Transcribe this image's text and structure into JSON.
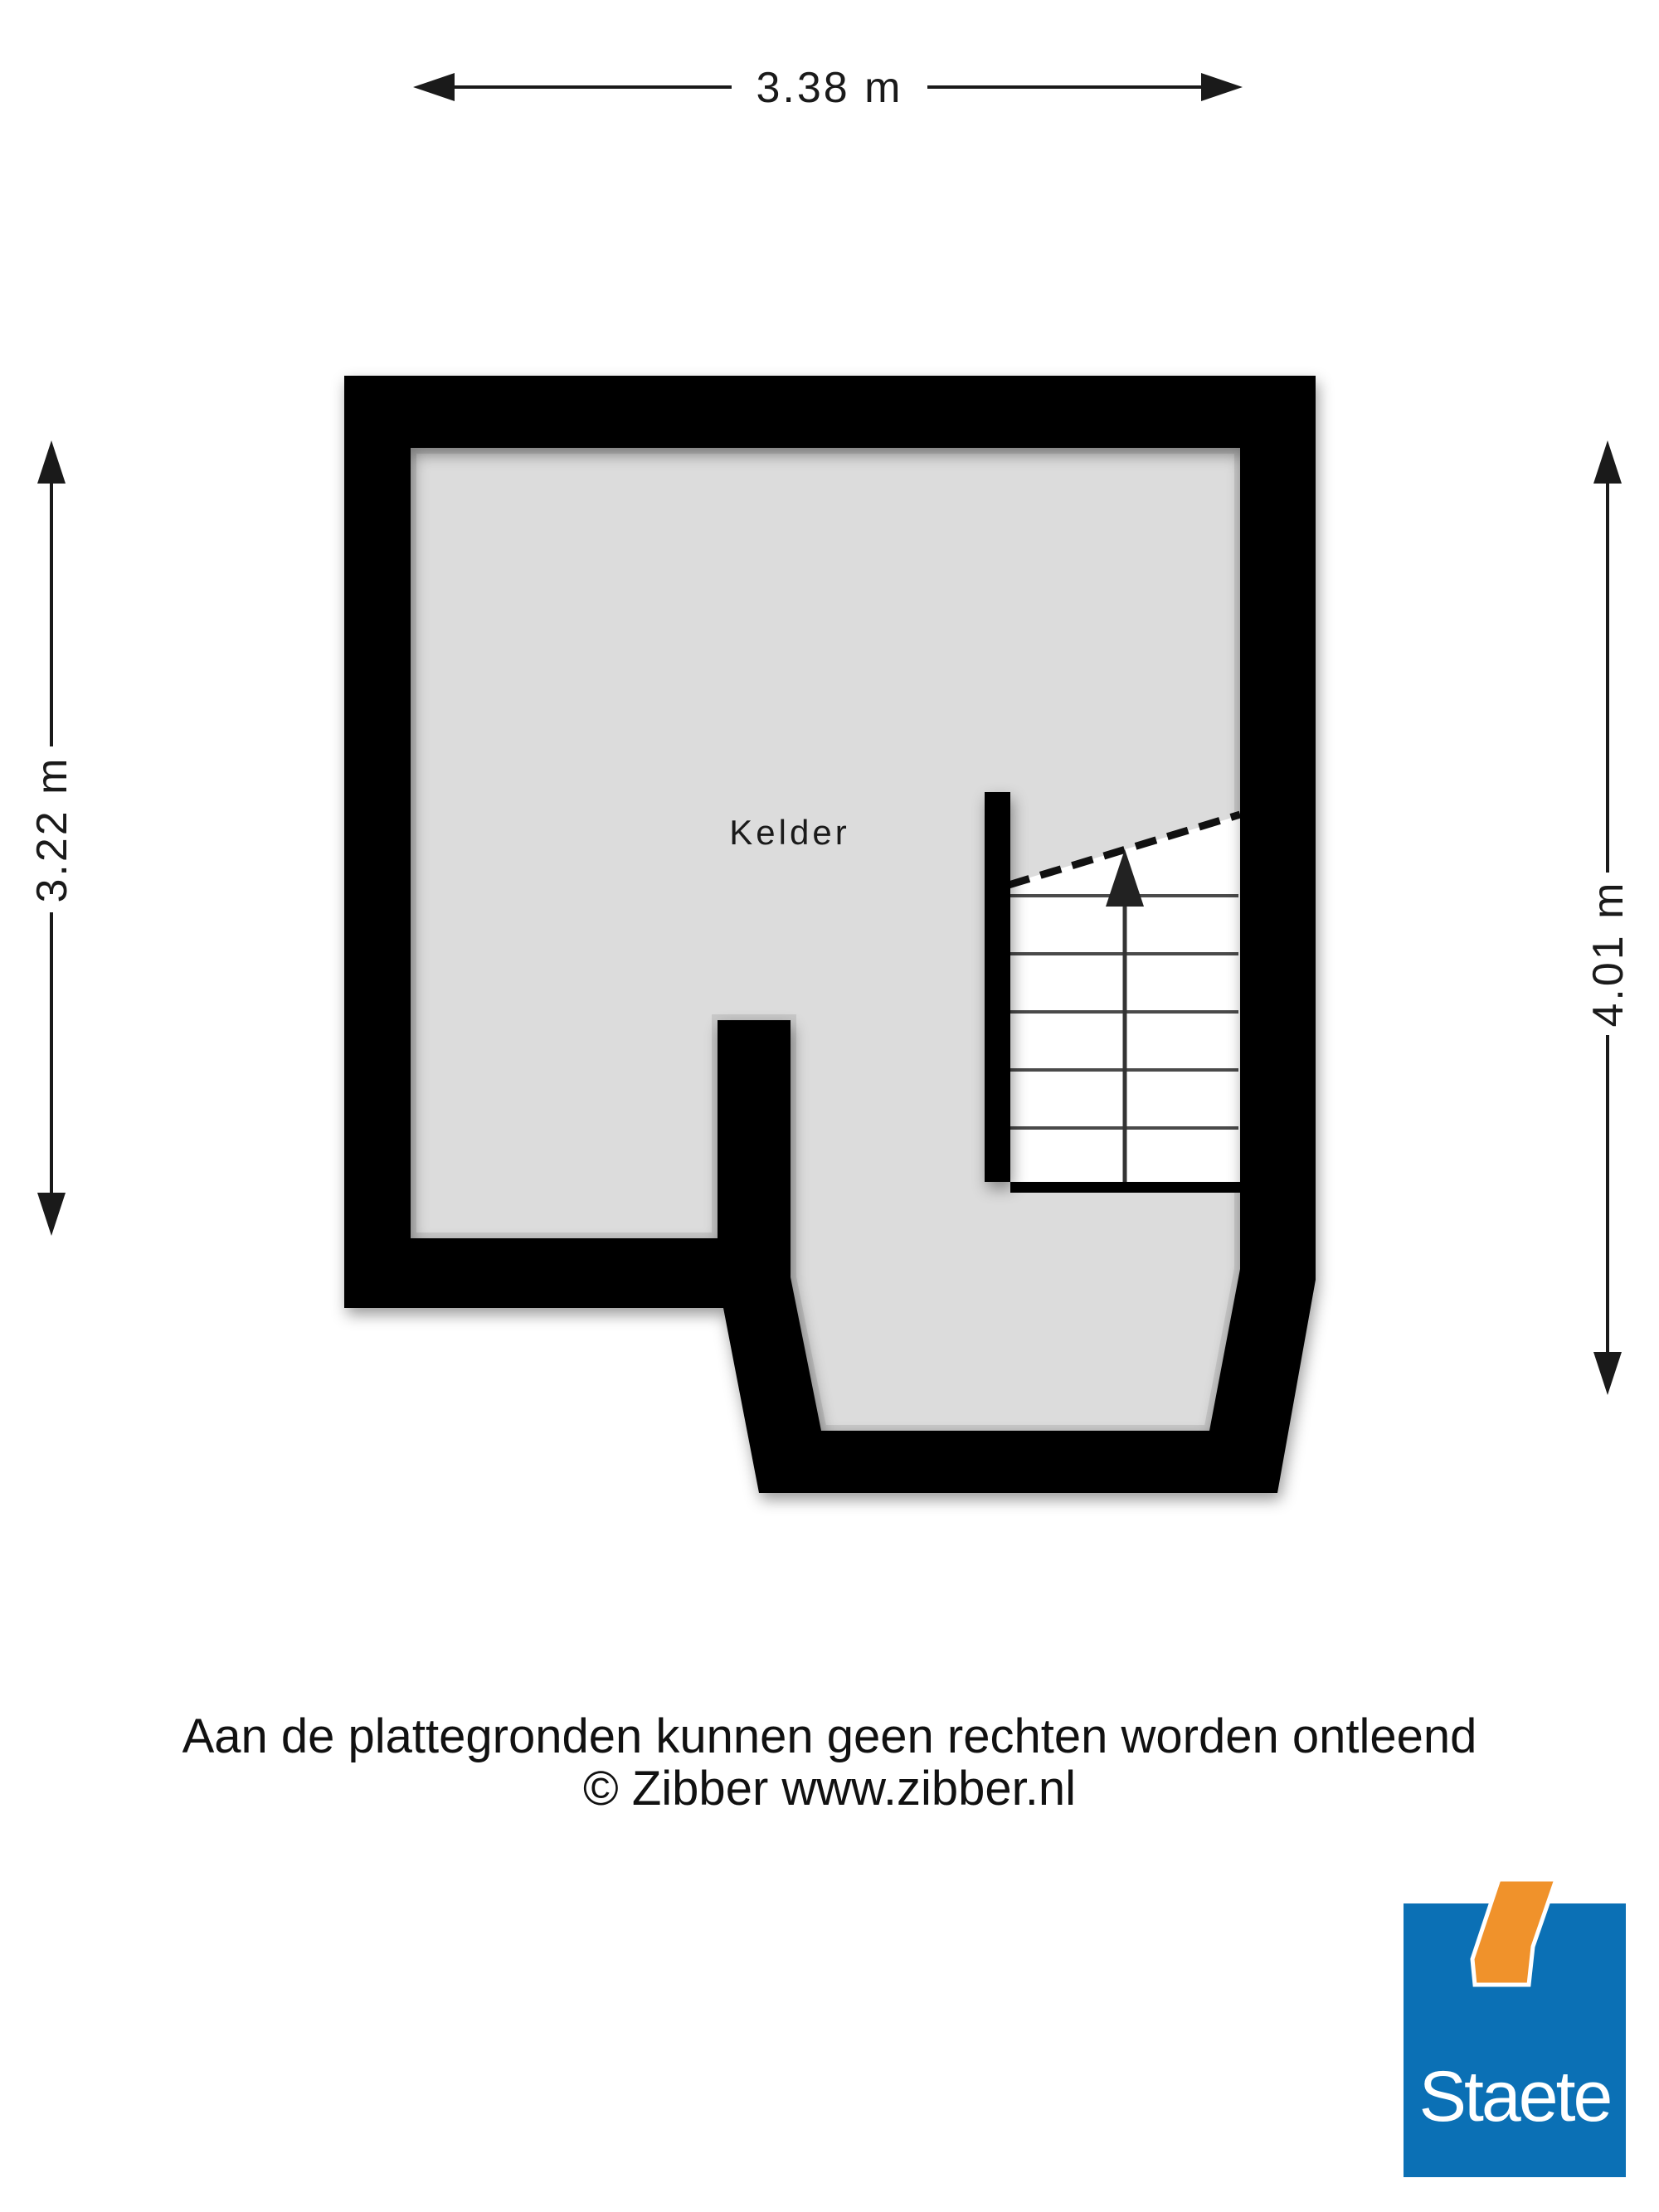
{
  "room": {
    "label": "Kelder"
  },
  "dimensions": {
    "top": "3.38 m",
    "left": "3.22 m",
    "right": "4.01 m"
  },
  "footer": {
    "disclaimer": "Aan de plattegronden kunnen geen rechten worden ontleend",
    "copyright": "© Zibber www.zibber.nl"
  },
  "logo": {
    "text": "Staete"
  },
  "colors": {
    "floor": "#dcdcdc",
    "wall": "#000000",
    "stairs_fill": "#ffffff",
    "tread_line": "#4a4a4a",
    "dimension": "#1a1a1a",
    "logo_blue": "#0b70b5",
    "logo_orange": "#f0922b"
  }
}
